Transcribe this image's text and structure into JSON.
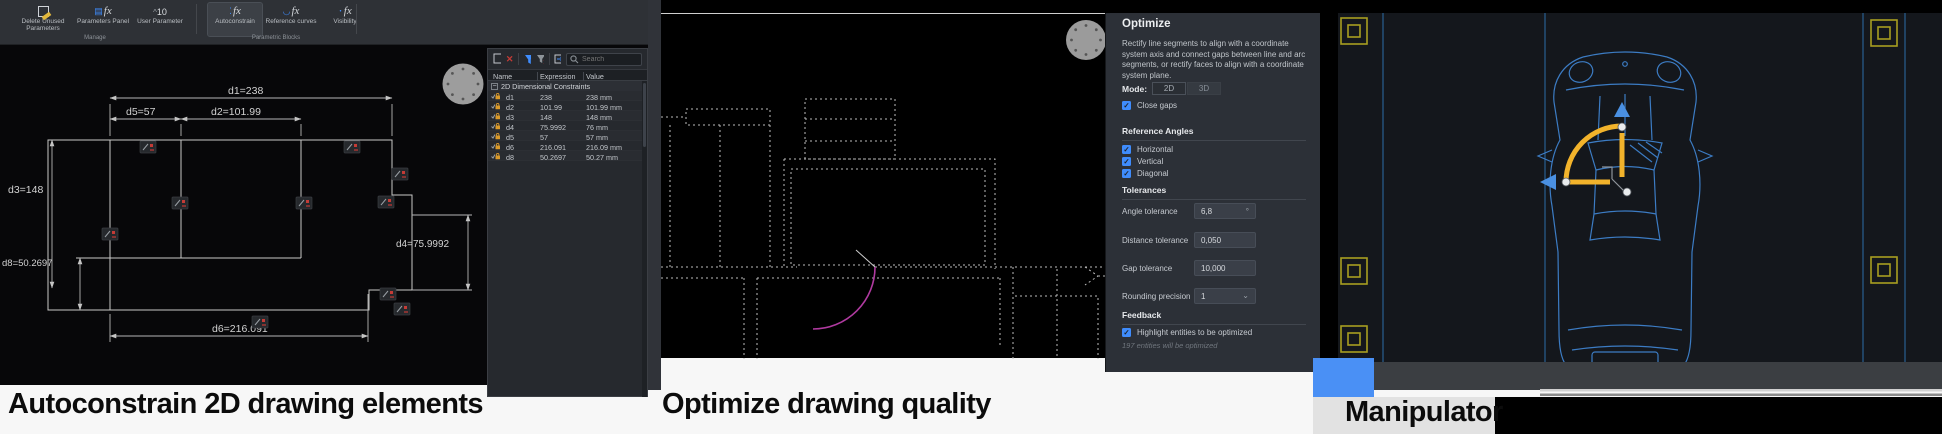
{
  "captions": {
    "card1": "Autoconstrain 2D drawing elements",
    "card2": "Optimize drawing quality",
    "card3": "Manipulator"
  },
  "glyphs": {
    "check": "✓",
    "minus": "−",
    "chevron_down": "⌄",
    "close": "✕",
    "caret": "^"
  },
  "card1": {
    "ribbon": {
      "buttons": [
        {
          "label": "Delete Unused Parameters",
          "icon": "broom-icon"
        },
        {
          "label": "Parameters Panel",
          "icon": "table-fx-icon"
        },
        {
          "label": "User Parameter",
          "icon": "number-10-icon",
          "number": "10"
        },
        {
          "label": "Autoconstrain",
          "icon": "fx-autoconstrain-icon",
          "active": true
        },
        {
          "label": "Reference curves",
          "icon": "fx-curves-icon"
        },
        {
          "label": "Visibility",
          "icon": "fx-visibility-icon"
        }
      ],
      "fx_glyph": "fx",
      "groups": [
        "Manage",
        "Parametric Blocks"
      ]
    },
    "drawing": {
      "dim_d1": "d1=238",
      "dim_d5": "d5=57",
      "dim_d2": "d2=101.99",
      "dim_d3": "d3=148",
      "dim_d8": "d8=50.2697",
      "dim_d4": "d4=75.9992",
      "dim_d6": "d6=216.091"
    },
    "params_panel": {
      "search_placeholder": "Search",
      "columns": [
        "Name",
        "Expression",
        "Value"
      ],
      "group_label": "2D Dimensional Constraints",
      "rows": [
        {
          "name": "d1",
          "expression": "238",
          "value": "238 mm"
        },
        {
          "name": "d2",
          "expression": "101.99",
          "value": "101.99 mm"
        },
        {
          "name": "d3",
          "expression": "148",
          "value": "148 mm"
        },
        {
          "name": "d4",
          "expression": "75.9992",
          "value": "76 mm"
        },
        {
          "name": "d5",
          "expression": "57",
          "value": "57 mm"
        },
        {
          "name": "d6",
          "expression": "216.091",
          "value": "216.09 mm"
        },
        {
          "name": "d8",
          "expression": "50.2697",
          "value": "50.27 mm"
        }
      ]
    }
  },
  "card2": {
    "optimize": {
      "title": "Optimize",
      "description": "Rectify line segments to align with a coordinate system axis and connect gaps between line and arc segments, or rectify faces to align with a coordinate system plane.",
      "mode_label": "Mode:",
      "mode_options": [
        "2D",
        "3D"
      ],
      "mode_selected": "2D",
      "close_gaps_label": "Close gaps",
      "sections": {
        "reference_angles": "Reference Angles",
        "tolerances": "Tolerances",
        "feedback": "Feedback"
      },
      "angles": [
        "Horizontal",
        "Vertical",
        "Diagonal"
      ],
      "fields": [
        {
          "label": "Angle tolerance",
          "value": "6,8",
          "suffix": "°"
        },
        {
          "label": "Distance tolerance",
          "value": "0,050"
        },
        {
          "label": "Gap tolerance",
          "value": "10,000"
        },
        {
          "label": "Rounding precision",
          "value": "1",
          "dropdown": true
        }
      ],
      "highlight_label": "Highlight entities to be optimized",
      "feedback_note": "197 entities will be optimized"
    }
  },
  "colors": {
    "accent_blue_square": "#4a90f5",
    "manipulator_yellow": "#f2b32b",
    "car_blue": "#3c7cc4",
    "door_arc_magenta": "#b03aa0",
    "checkbox_blue": "#3f8cfc",
    "marker_yellow": "#a89e20",
    "constraint_red": "#c43b36"
  }
}
